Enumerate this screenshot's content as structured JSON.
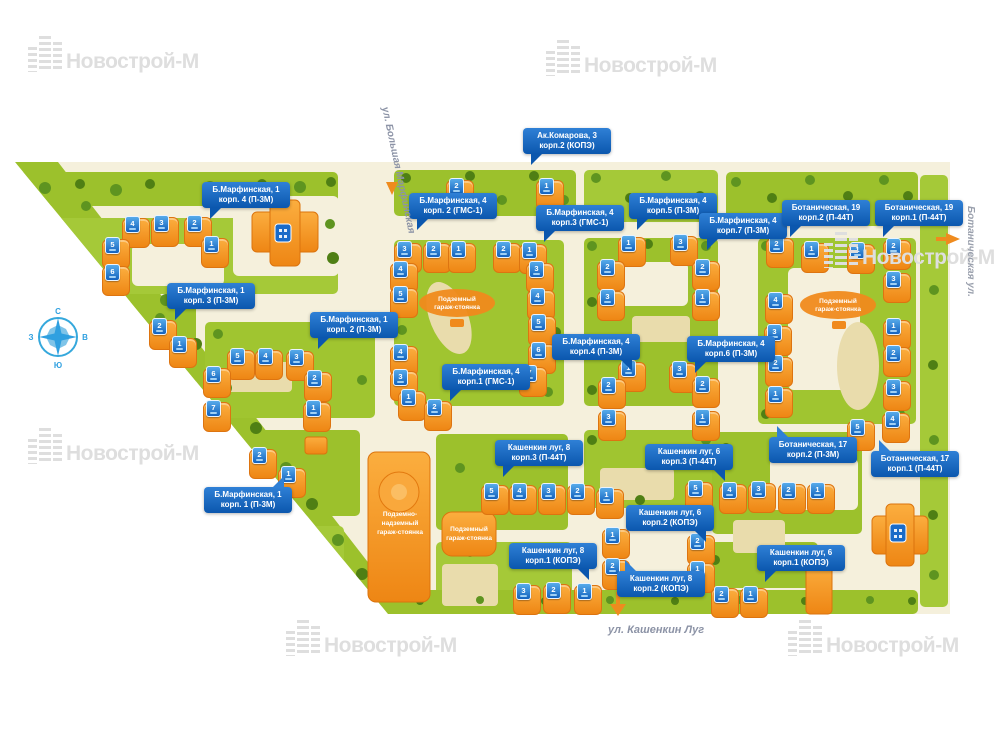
{
  "watermark": {
    "text": "Новострой-М"
  },
  "compass": {
    "north": "С",
    "east": "В",
    "south": "Ю",
    "west": "З"
  },
  "streets": {
    "bolshaya_marfinskaya": "ул. Большая Марфинская",
    "botanicheskaya": "Ботаническая ул.",
    "kashenkin_lug": "ул. Кашенкин Луг"
  },
  "garages": {
    "center_park": {
      "l1": "Подземный",
      "l2": "гараж-стоянка"
    },
    "right_park": {
      "l1": "Подземный",
      "l2": "гараж-стоянка"
    },
    "big": {
      "l1": "Подземно-",
      "l2": "надземный",
      "l3": "гараж-стоянка"
    },
    "small": {
      "l1": "Подземный",
      "l2": "гараж-стоянка"
    }
  },
  "colors": {
    "building_orange": "#F6951D",
    "label_blue": "#0B57AE",
    "badge_blue": "#1463BE",
    "grass_green": "#9CC12C",
    "map_cream": "#F5F0DC"
  },
  "building_labels": [
    {
      "id": "bmarf1-4",
      "line1": "Б.Марфинская, 1",
      "line2": "корп. 4  (П-3М)",
      "x": 202,
      "y": 182,
      "tail": "bl"
    },
    {
      "id": "bmarf1-3",
      "line1": "Б.Марфинская, 1",
      "line2": "корп. 3  (П-3М)",
      "x": 167,
      "y": 283,
      "tail": "bl"
    },
    {
      "id": "bmarf1-2",
      "line1": "Б.Марфинская, 1",
      "line2": "корп. 2  (П-3М)",
      "x": 310,
      "y": 312,
      "tail": "bl"
    },
    {
      "id": "bmarf1-1",
      "line1": "Б.Марфинская, 1",
      "line2": "корп. 1  (П-3М)",
      "x": 204,
      "y": 487,
      "tail": "tr"
    },
    {
      "id": "bmarf4-2",
      "line1": "Б.Марфинская, 4",
      "line2": "корп. 2  (ГМС-1)",
      "x": 409,
      "y": 193,
      "tail": "bl"
    },
    {
      "id": "bmarf4-3",
      "line1": "Б.Марфинская, 4",
      "line2": "корп.3  (ГМС-1)",
      "x": 536,
      "y": 205,
      "tail": "bl"
    },
    {
      "id": "akkomarova3-2",
      "line1": "Ак.Комарова, 3",
      "line2": "корп.2  (КОПЭ)",
      "x": 523,
      "y": 128,
      "tail": "bl"
    },
    {
      "id": "bmarf4-5",
      "line1": "Б.Марфинская, 4",
      "line2": "корп.5  (П-3М)",
      "x": 629,
      "y": 193,
      "tail": "bl"
    },
    {
      "id": "bmarf4-7",
      "line1": "Б.Марфинская, 4",
      "line2": "корп.7  (П-3М)",
      "x": 699,
      "y": 213,
      "tail": "bl"
    },
    {
      "id": "botan19-2",
      "line1": "Ботаническая, 19",
      "line2": "корп.2  (П-44Т)",
      "x": 782,
      "y": 200,
      "tail": "bl"
    },
    {
      "id": "botan19-1",
      "line1": "Ботаническая, 19",
      "line2": "корп.1  (П-44Т)",
      "x": 875,
      "y": 200,
      "tail": "bl"
    },
    {
      "id": "bmarf4-1",
      "line1": "Б.Марфинская, 4",
      "line2": "корп.1  (ГМС-1)",
      "x": 442,
      "y": 364,
      "tail": "bl"
    },
    {
      "id": "bmarf4-4",
      "line1": "Б.Марфинская, 4",
      "line2": "корп.4  (П-3М)",
      "x": 552,
      "y": 334,
      "tail": "br"
    },
    {
      "id": "bmarf4-6",
      "line1": "Б.Марфинская, 4",
      "line2": "корп.6  (П-3М)",
      "x": 687,
      "y": 336,
      "tail": "bl"
    },
    {
      "id": "kashlug8-3",
      "line1": "Кашенкин луг, 8",
      "line2": "корп.3  (П-44Т)",
      "x": 495,
      "y": 440,
      "tail": "bl"
    },
    {
      "id": "kashlug6-3",
      "line1": "Кашенкин луг, 6",
      "line2": "корп.3  (П-44Т)",
      "x": 645,
      "y": 444,
      "tail": "br"
    },
    {
      "id": "botan17-2",
      "line1": "Ботаническая, 17",
      "line2": "корп.2  (П-3М)",
      "x": 769,
      "y": 437,
      "tail": "tl"
    },
    {
      "id": "botan17-1",
      "line1": "Ботаническая, 17",
      "line2": "корп.1  (П-44Т)",
      "x": 871,
      "y": 451,
      "tail": "tl"
    },
    {
      "id": "kashlug6-2",
      "line1": "Кашенкин луг, 6",
      "line2": "корп.2  (КОПЭ)",
      "x": 626,
      "y": 505,
      "tail": "br"
    },
    {
      "id": "kashlug8-1",
      "line1": "Кашенкин луг, 8",
      "line2": "корп.1  (КОПЭ)",
      "x": 509,
      "y": 543,
      "tail": "br"
    },
    {
      "id": "kashlug6-1",
      "line1": "Кашенкин луг, 6",
      "line2": "корп.1  (КОПЭ)",
      "x": 757,
      "y": 545,
      "tail": "bl"
    },
    {
      "id": "kashlug8-2",
      "line1": "Кашенкин луг, 8",
      "line2": "корп.2  (КОПЭ)",
      "x": 617,
      "y": 571,
      "tail": "tl"
    }
  ],
  "section_badges": [
    {
      "n": "4",
      "x": 132,
      "y": 224
    },
    {
      "n": "3",
      "x": 161,
      "y": 223
    },
    {
      "n": "2",
      "x": 194,
      "y": 223
    },
    {
      "n": "1",
      "x": 211,
      "y": 244
    },
    {
      "n": "5",
      "x": 112,
      "y": 245
    },
    {
      "n": "6",
      "x": 112,
      "y": 272
    },
    {
      "n": "2",
      "x": 159,
      "y": 326
    },
    {
      "n": "1",
      "x": 179,
      "y": 344
    },
    {
      "n": "5",
      "x": 237,
      "y": 356
    },
    {
      "n": "4",
      "x": 265,
      "y": 356
    },
    {
      "n": "3",
      "x": 296,
      "y": 357
    },
    {
      "n": "6",
      "x": 213,
      "y": 374
    },
    {
      "n": "7",
      "x": 213,
      "y": 408
    },
    {
      "n": "2",
      "x": 314,
      "y": 378
    },
    {
      "n": "1",
      "x": 313,
      "y": 408
    },
    {
      "n": "2",
      "x": 259,
      "y": 455
    },
    {
      "n": "1",
      "x": 288,
      "y": 474
    },
    {
      "n": "3",
      "x": 404,
      "y": 249
    },
    {
      "n": "2",
      "x": 433,
      "y": 249
    },
    {
      "n": "1",
      "x": 458,
      "y": 249
    },
    {
      "n": "4",
      "x": 400,
      "y": 269
    },
    {
      "n": "5",
      "x": 400,
      "y": 294
    },
    {
      "n": "2",
      "x": 503,
      "y": 249
    },
    {
      "n": "1",
      "x": 529,
      "y": 250
    },
    {
      "n": "3",
      "x": 536,
      "y": 269
    },
    {
      "n": "4",
      "x": 537,
      "y": 296
    },
    {
      "n": "5",
      "x": 538,
      "y": 322
    },
    {
      "n": "6",
      "x": 538,
      "y": 350
    },
    {
      "n": "7",
      "x": 529,
      "y": 373
    },
    {
      "n": "4",
      "x": 400,
      "y": 352
    },
    {
      "n": "3",
      "x": 400,
      "y": 377
    },
    {
      "n": "1",
      "x": 408,
      "y": 397
    },
    {
      "n": "2",
      "x": 434,
      "y": 407
    },
    {
      "n": "2",
      "x": 456,
      "y": 186
    },
    {
      "n": "1",
      "x": 546,
      "y": 186
    },
    {
      "n": "1",
      "x": 628,
      "y": 243
    },
    {
      "n": "2",
      "x": 607,
      "y": 267
    },
    {
      "n": "3",
      "x": 607,
      "y": 297
    },
    {
      "n": "3",
      "x": 680,
      "y": 242
    },
    {
      "n": "2",
      "x": 702,
      "y": 267
    },
    {
      "n": "1",
      "x": 702,
      "y": 297
    },
    {
      "n": "1",
      "x": 628,
      "y": 368
    },
    {
      "n": "2",
      "x": 608,
      "y": 385
    },
    {
      "n": "3",
      "x": 608,
      "y": 417
    },
    {
      "n": "3",
      "x": 679,
      "y": 369
    },
    {
      "n": "2",
      "x": 702,
      "y": 384
    },
    {
      "n": "1",
      "x": 702,
      "y": 417
    },
    {
      "n": "2",
      "x": 776,
      "y": 244
    },
    {
      "n": "1",
      "x": 811,
      "y": 249
    },
    {
      "n": "1",
      "x": 857,
      "y": 250
    },
    {
      "n": "2",
      "x": 893,
      "y": 246
    },
    {
      "n": "3",
      "x": 893,
      "y": 279
    },
    {
      "n": "4",
      "x": 775,
      "y": 300
    },
    {
      "n": "3",
      "x": 774,
      "y": 332
    },
    {
      "n": "2",
      "x": 775,
      "y": 363
    },
    {
      "n": "1",
      "x": 775,
      "y": 394
    },
    {
      "n": "1",
      "x": 893,
      "y": 326
    },
    {
      "n": "2",
      "x": 893,
      "y": 353
    },
    {
      "n": "3",
      "x": 893,
      "y": 387
    },
    {
      "n": "4",
      "x": 892,
      "y": 419
    },
    {
      "n": "5",
      "x": 857,
      "y": 427
    },
    {
      "n": "5",
      "x": 491,
      "y": 491
    },
    {
      "n": "4",
      "x": 519,
      "y": 491
    },
    {
      "n": "3",
      "x": 548,
      "y": 491
    },
    {
      "n": "2",
      "x": 577,
      "y": 491
    },
    {
      "n": "1",
      "x": 606,
      "y": 495
    },
    {
      "n": "5",
      "x": 695,
      "y": 488
    },
    {
      "n": "4",
      "x": 729,
      "y": 490
    },
    {
      "n": "3",
      "x": 758,
      "y": 489
    },
    {
      "n": "2",
      "x": 788,
      "y": 490
    },
    {
      "n": "1",
      "x": 817,
      "y": 490
    },
    {
      "n": "1",
      "x": 612,
      "y": 535
    },
    {
      "n": "2",
      "x": 612,
      "y": 566
    },
    {
      "n": "3",
      "x": 523,
      "y": 591
    },
    {
      "n": "2",
      "x": 553,
      "y": 590
    },
    {
      "n": "1",
      "x": 584,
      "y": 591
    },
    {
      "n": "2",
      "x": 697,
      "y": 541
    },
    {
      "n": "1",
      "x": 697,
      "y": 569
    },
    {
      "n": "2",
      "x": 721,
      "y": 594
    },
    {
      "n": "1",
      "x": 750,
      "y": 594
    }
  ],
  "watermark_positions": [
    {
      "x": 28,
      "y": 36
    },
    {
      "x": 546,
      "y": 40
    },
    {
      "x": 824,
      "y": 232
    },
    {
      "x": 28,
      "y": 428
    },
    {
      "x": 286,
      "y": 620
    },
    {
      "x": 788,
      "y": 620
    }
  ]
}
